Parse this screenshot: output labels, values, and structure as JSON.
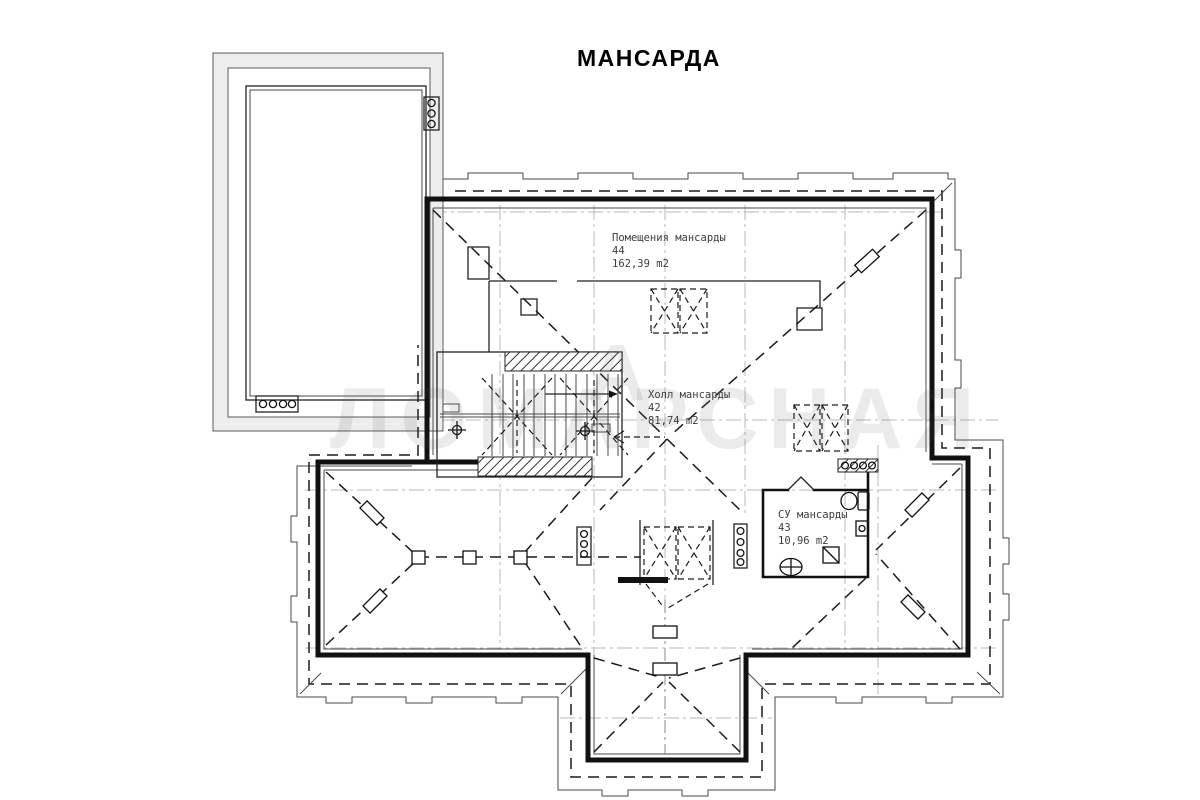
{
  "title": "МАНСАРДА",
  "watermark": "ЛОМАРСНАЯ",
  "watermark_accent": "А",
  "rooms": [
    {
      "name": "Помещения мансарды",
      "number": "44",
      "area": "162,39 m2"
    },
    {
      "name": "Холл мансарды",
      "number": "42",
      "area": "81,74 m2"
    },
    {
      "name": "СУ мансарды",
      "number": "43",
      "area": "10,96 m2"
    }
  ],
  "colors": {
    "paper": "#ffffff",
    "ink": "#111111",
    "grid": "#b9b9b9",
    "shade": "#ededed"
  }
}
